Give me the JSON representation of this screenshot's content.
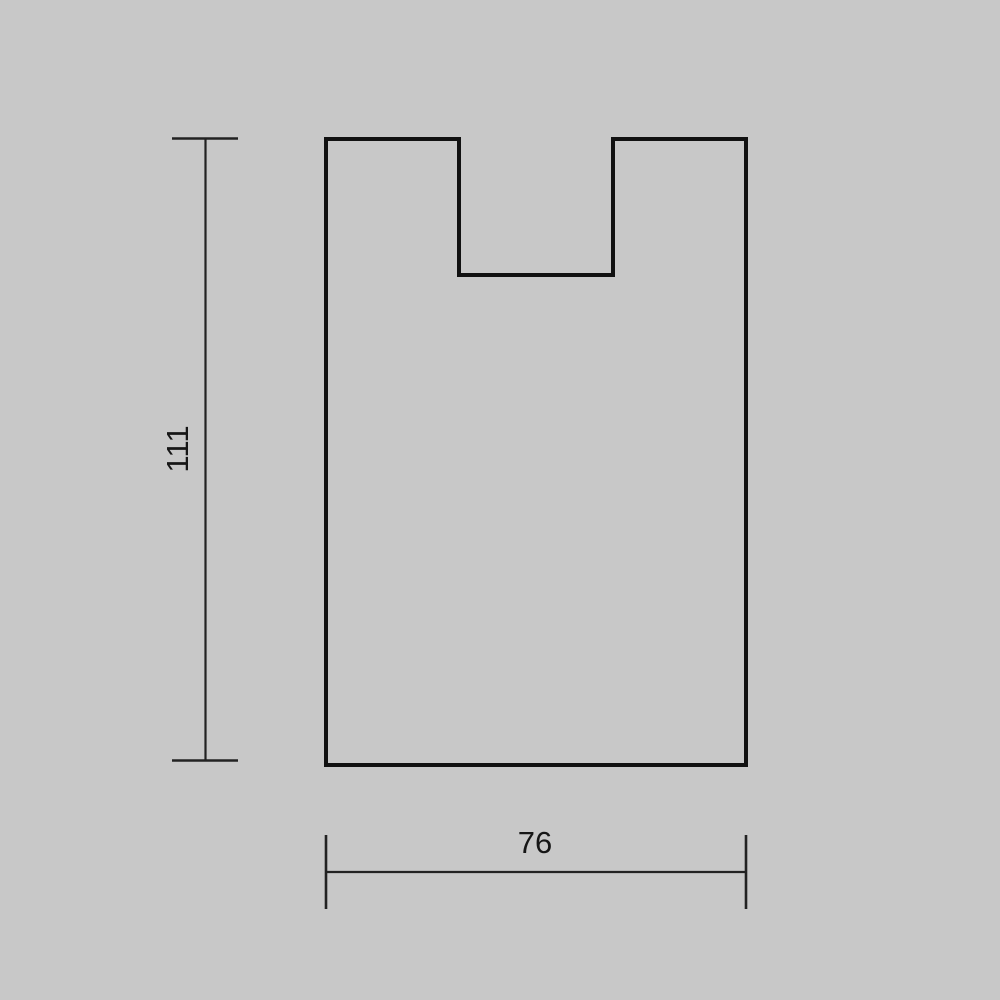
{
  "page": {
    "background_color": "#c8c8c8"
  },
  "drawing": {
    "description": "Technical outline drawing of a rectangular plate with a rectangular notch cut into the top edge, annotated with two linear dimensions",
    "outline_color": "#111111",
    "dimension_line_color": "#222222",
    "text_color": "#161616",
    "vertical_dimension": {
      "label": "111",
      "value": 111,
      "orientation": "vertical",
      "measures": "overall height of the part"
    },
    "horizontal_dimension": {
      "label": "76",
      "value": 76,
      "orientation": "horizontal",
      "measures": "overall width of the part"
    }
  }
}
